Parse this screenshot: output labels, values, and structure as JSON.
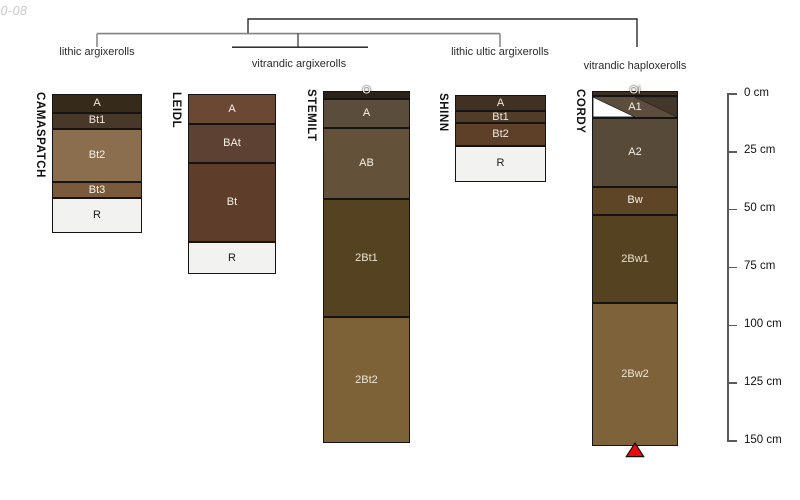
{
  "watermark": "10-08",
  "classification": {
    "taxa": [
      {
        "label": "lithic argixerolls"
      },
      {
        "label": "vitrandic argixerolls"
      },
      {
        "label": "lithic ultic argixerolls"
      },
      {
        "label": "vitrandic haploxerolls"
      }
    ]
  },
  "depth_scale": {
    "unit": "cm",
    "min_cm": 0,
    "max_cm": 150,
    "ticks": [
      {
        "cm": 0,
        "label": "0 cm"
      },
      {
        "cm": 25,
        "label": "25 cm"
      },
      {
        "cm": 50,
        "label": "50 cm"
      },
      {
        "cm": 75,
        "label": "75 cm"
      },
      {
        "cm": 100,
        "label": "100 cm"
      },
      {
        "cm": 125,
        "label": "125 cm"
      },
      {
        "cm": 150,
        "label": "150 cm"
      }
    ]
  },
  "profiles": [
    {
      "name": "CAMASPATCH",
      "taxon": "lithic argixerolls",
      "horizons": [
        {
          "label": "A",
          "top_cm": 0,
          "bottom_cm": 8,
          "color": "#362a1b",
          "text": "#efe9df"
        },
        {
          "label": "Bt1",
          "top_cm": 8,
          "bottom_cm": 15,
          "color": "#473827",
          "text": "#efe9df"
        },
        {
          "label": "Bt2",
          "top_cm": 15,
          "bottom_cm": 38,
          "color": "#8a6e4d",
          "text": "#f6f2ea"
        },
        {
          "label": "Bt3",
          "top_cm": 38,
          "bottom_cm": 45,
          "color": "#7a5a3a",
          "text": "#f6f2ea"
        },
        {
          "label": "R",
          "top_cm": 45,
          "bottom_cm": 60,
          "color": "#f2f2f1",
          "text": "#1b1b1b"
        }
      ]
    },
    {
      "name": "LEIDL",
      "taxon": "vitrandic argixerolls",
      "horizons": [
        {
          "label": "A",
          "top_cm": 0,
          "bottom_cm": 13,
          "color": "#6a4833",
          "text": "#f6f2ea"
        },
        {
          "label": "BAt",
          "top_cm": 13,
          "bottom_cm": 30,
          "color": "#5d4233",
          "text": "#f6f2ea"
        },
        {
          "label": "Bt",
          "top_cm": 30,
          "bottom_cm": 64,
          "color": "#5e3d2a",
          "text": "#f6f2ea"
        },
        {
          "label": "R",
          "top_cm": 64,
          "bottom_cm": 78,
          "color": "#f2f2f1",
          "text": "#1b1b1b"
        }
      ]
    },
    {
      "name": "STEMILT",
      "taxon": "vitrandic argixerolls",
      "horizons": [
        {
          "label": "O",
          "top_cm": -1.5,
          "bottom_cm": 2,
          "color": "#2b2218",
          "text": "#ffffff",
          "label_pos": "top-edge"
        },
        {
          "label": "A",
          "top_cm": 2,
          "bottom_cm": 14.5,
          "color": "#5b4d3c",
          "text": "#f6f2ea"
        },
        {
          "label": "AB",
          "top_cm": 14.5,
          "bottom_cm": 45.5,
          "color": "#64513a",
          "text": "#f6f2ea"
        },
        {
          "label": "2Bt1",
          "top_cm": 45.5,
          "bottom_cm": 96.5,
          "color": "#554220",
          "text": "#e9e1d2"
        },
        {
          "label": "2Bt2",
          "top_cm": 96.5,
          "bottom_cm": 151,
          "color": "#7d6238",
          "text": "#ece5d8"
        }
      ]
    },
    {
      "name": "SHINN",
      "taxon": "lithic ultic argixerolls",
      "horizons": [
        {
          "label": "A",
          "top_cm": 0.5,
          "bottom_cm": 7.5,
          "color": "#413122",
          "text": "#efe9df"
        },
        {
          "label": "Bt1",
          "top_cm": 7.5,
          "bottom_cm": 12.5,
          "color": "#503c28",
          "text": "#efe9df"
        },
        {
          "label": "Bt2",
          "top_cm": 12.5,
          "bottom_cm": 22.5,
          "color": "#5e3f28",
          "text": "#efe9df"
        },
        {
          "label": "R",
          "top_cm": 22.5,
          "bottom_cm": 38,
          "color": "#f2f2f1",
          "text": "#1b1b1b"
        }
      ]
    },
    {
      "name": "CORDY",
      "taxon": "vitrandic haploxerolls",
      "horizons": [
        {
          "label": "Oi",
          "top_cm": -1.5,
          "bottom_cm": 1,
          "color": "#3a2f20",
          "text": "#ffffff",
          "label_pos": "top-edge"
        },
        {
          "label": "A1",
          "top_cm": 1,
          "bottom_cm": 10.5,
          "color": "#5d4d3d",
          "text": "#f6f2ea",
          "boundary": "diagonal",
          "diagonal_gap_color": "#ffffff",
          "diagonal_wedge_color": "#44382a"
        },
        {
          "label": "A2",
          "top_cm": 10.5,
          "bottom_cm": 40,
          "color": "#574a39",
          "text": "#f6f2ea"
        },
        {
          "label": "Bw",
          "top_cm": 40,
          "bottom_cm": 52.5,
          "color": "#5e4526",
          "text": "#f6f2ea"
        },
        {
          "label": "2Bw1",
          "top_cm": 52.5,
          "bottom_cm": 90.5,
          "color": "#554220",
          "text": "#e9e1d2"
        },
        {
          "label": "2Bw2",
          "top_cm": 90.5,
          "bottom_cm": 152,
          "color": "#7e6239",
          "text": "#ece5d8"
        }
      ]
    }
  ],
  "marker": {
    "shape": "triangle-up",
    "color": "#ec0b0b",
    "below_profile": "CORDY"
  },
  "colors": {
    "tree_primary": "#2b2b2b",
    "tree_secondary": "#828282",
    "horizon_border": "#141414",
    "rock_fill": "#f2f2f1"
  }
}
